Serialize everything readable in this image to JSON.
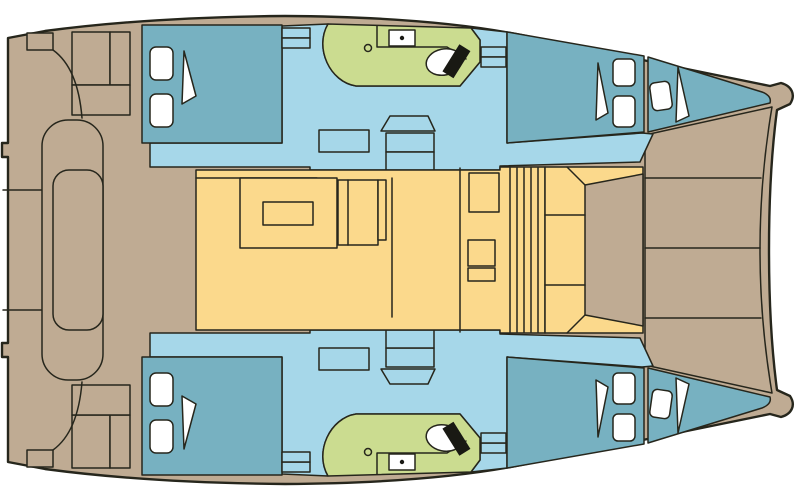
{
  "diagram": {
    "type": "boat-floorplan",
    "subject": "catamaran deck and interior layout plan view, bow to the right, two symmetric hulls",
    "regions": {
      "aft_cockpit": "aft cockpit with bench seat and table",
      "salon": "central salon with dining table",
      "galley": "galley counter and island",
      "forward_cockpit": "forward cockpit with U seat and lounge pad",
      "foredeck": "foredeck panels between the bows",
      "port_aft_cabin": "port aft double cabin",
      "port_bathroom": "port head with toilet and sink",
      "port_forward_cabin": "port forward double cabin",
      "port_forepeak": "port forepeak berth",
      "starboard_hull": "mirrored starboard hull with same cabins and head"
    },
    "fixtures": [
      "berth-pillow",
      "door-swing",
      "toilet",
      "sink",
      "drain",
      "steps-hatch"
    ]
  },
  "colors": {
    "background": "#ffffff",
    "outline": "#26261c",
    "deck": "#bfab93",
    "salon_floor": "#fbd98c",
    "corridor": "#a6d7e9",
    "cabin": "#77b1c1",
    "bathroom": "#cbdc90",
    "fixture_white": "#ffffff",
    "fixture_black": "#191913"
  }
}
